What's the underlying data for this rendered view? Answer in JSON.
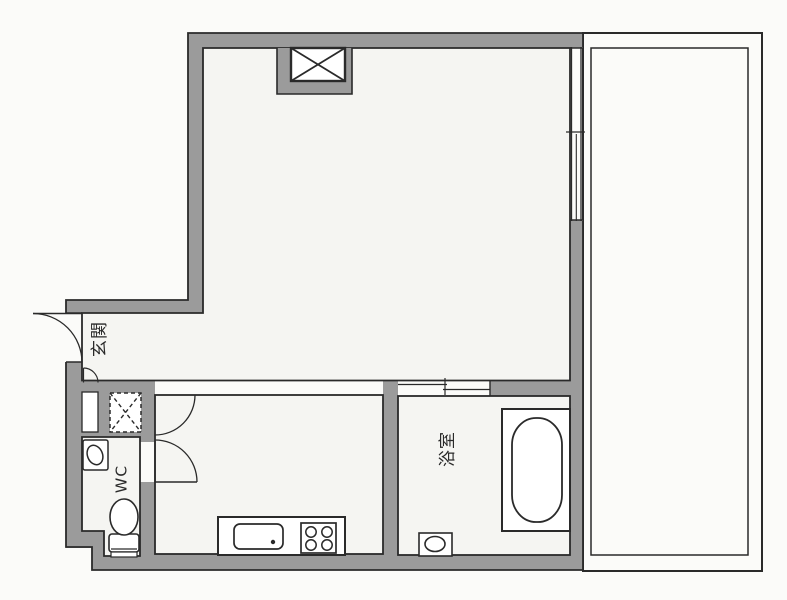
{
  "page": {
    "type": "apartment floor plan (1K layout)"
  },
  "labels": {
    "entrance": "玄関",
    "water_closet": "WC",
    "bathroom": "浴室"
  },
  "symbols": {
    "shaft_x": "boxed-x shaft symbol",
    "pipe_space": "dashed-x pipe-space symbol",
    "door_swing": "quarter-circle door swing",
    "sliding_door": "offset parallel-line sliding door"
  },
  "colors": {
    "wall": "#9b9b9b",
    "line": "#2a2a2a",
    "floor": "#f5f5f2",
    "paper": "#fbfbf9",
    "fixture": "#ffffff"
  }
}
